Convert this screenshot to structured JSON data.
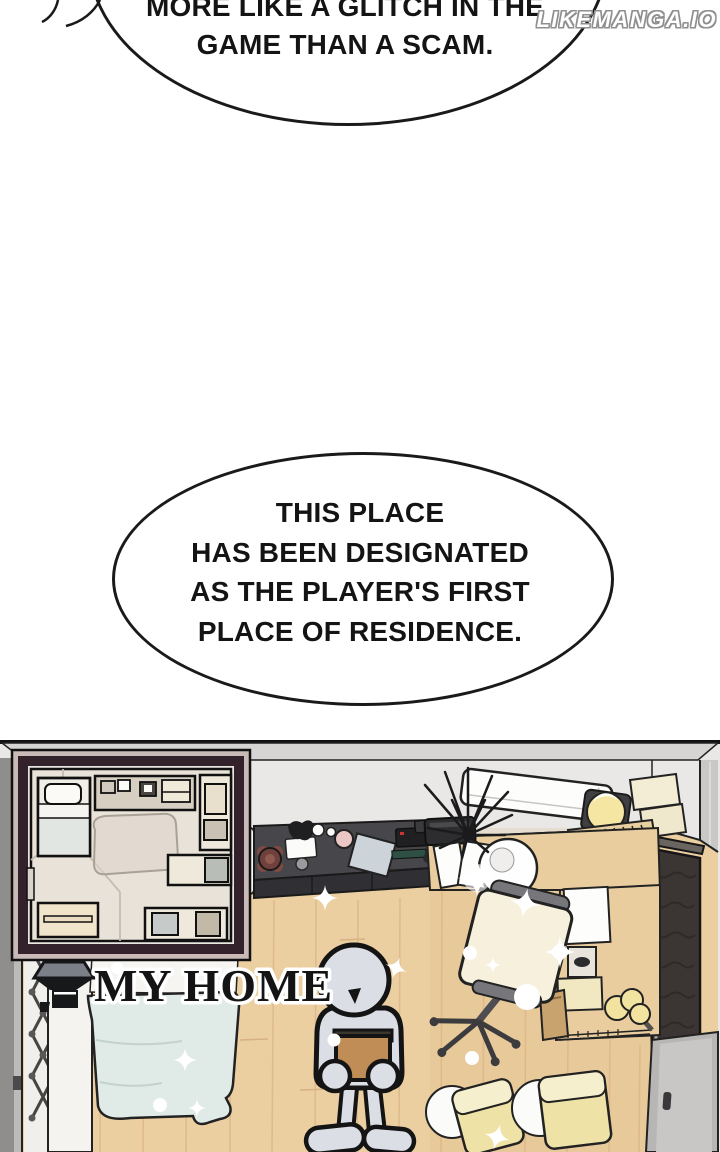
{
  "watermark": {
    "text": "LIKEMANGA.IO"
  },
  "speech_bubbles": [
    {
      "id": "top",
      "lines": [
        "MORE LIKE A GLITCH IN THE",
        "GAME THAN A SCAM."
      ]
    },
    {
      "id": "residence",
      "lines": [
        "THIS PLACE",
        "HAS BEEN DESIGNATED",
        "AS THE PLAYER'S FIRST",
        "PLACE OF RESIDENCE."
      ]
    }
  ],
  "panel": {
    "location_label": {
      "icon": "home-icon",
      "text": "MY HOME"
    },
    "minimap": {
      "type": "floor-plan",
      "border_color": "#33222b"
    },
    "palette": {
      "floor_wood": "#eccfa1",
      "wall_gray": "#e9e8e6",
      "blanket_mint": "#e0eae6",
      "cushion_yellow": "#efe2a6",
      "character_gray": "#dcdee6",
      "wardrobe_dark": "#3b3634",
      "lamp_yellow": "#f5e7a3"
    }
  }
}
